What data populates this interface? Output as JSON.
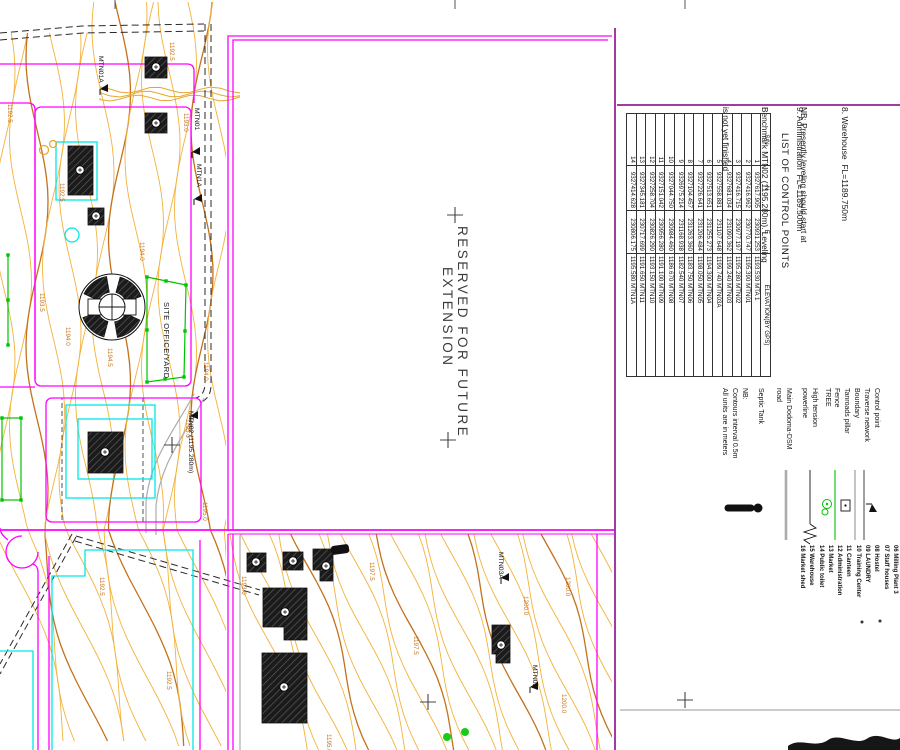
{
  "sheet": {
    "fl_notes": [
      "8. Warehouse  FL=1189.750m",
      "9. Administration  FL=1189.500m"
    ],
    "nb_note_lines": [
      "NB: Presently leveling should start at",
      "Benchmark MTN02 (1195.280m). Leveling",
      "is not yet finished"
    ],
    "table": {
      "title": "LIST OF CONTROL POINTS",
      "columns": [
        "S/N",
        "N",
        "E",
        "ELEVATION(BY GPS)"
      ],
      "rows": [
        [
          "1",
          "9327617.905",
          "230931.253",
          "1193.530 MTA 1"
        ],
        [
          "2",
          "9327416.962",
          "230770.747",
          "1195.390 MTN01"
        ],
        [
          "3",
          "9327416.715",
          "230977.197",
          "1195.280 MTN02"
        ],
        [
          "4",
          "9327681.034",
          "231090.362",
          "1199.240 MTN03"
        ],
        [
          "5",
          "9327558.881",
          "231107.648",
          "1199.740 MTN03A"
        ],
        [
          "6",
          "9327513.651",
          "231255.273",
          "1194.300 MTN04"
        ],
        [
          "7",
          "9327226.641",
          "231206.484",
          "1198.050 MTN05"
        ],
        [
          "8",
          "9327104.457",
          "231263.360",
          "1183.750 MTN06"
        ],
        [
          "9",
          "9326975.214",
          "231168.938",
          "1182.540 MTN07"
        ],
        [
          "10",
          "9327044.750",
          "230984.460",
          "1186.670 MTN08"
        ],
        [
          "11",
          "9327151.042",
          "230956.280",
          "1191.100 MTN09"
        ],
        [
          "12",
          "9327258.704",
          "230826.290",
          "1193.150 MTN10"
        ],
        [
          "13",
          "9327345.181",
          "230717.699",
          "1191.650 MTN11"
        ],
        [
          "14",
          "9327414.628",
          "230806.175",
          "1195.580 MTN1A"
        ]
      ]
    },
    "legend": {
      "items": [
        {
          "symbol": "control-point",
          "lines": [
            "Control point"
          ]
        },
        {
          "symbol": "traverse-network",
          "lines": [
            "Traverse network"
          ]
        },
        {
          "symbol": "boundary",
          "lines": [
            "Boundary"
          ]
        },
        {
          "symbol": "tanroads-pillar",
          "lines": [
            "Tanroads pillar"
          ]
        },
        {
          "symbol": "fence",
          "lines": [
            "Fence"
          ]
        },
        {
          "symbol": "tree",
          "lines": [
            "TREE"
          ]
        },
        {
          "symbol": "high-tension-powerline",
          "lines": [
            "High tension",
            "powerline"
          ]
        },
        {
          "symbol": "main-road",
          "lines": [
            "Main Dodoma-DSM",
            "road"
          ]
        },
        {
          "symbol": "septic-tank",
          "lines": [
            "Septic Tank"
          ]
        }
      ],
      "notes": [
        "NB:",
        "Contours interval 0.5m",
        "All units are in meters"
      ]
    },
    "building_list": [
      "06 Milling Plant 3",
      "07 Staff houses",
      "08 Hostel",
      "09 LAUNDRY",
      "10 Training Center",
      "11 Canteen",
      "12 Administration",
      "13 Market",
      "14 Public toilet",
      "15 Warehouse",
      "16 Market shed"
    ]
  },
  "map": {
    "reserved_label_lines": [
      "RESERVED FOR FUTURE",
      "EXTENSION"
    ],
    "point_labels": [
      "MTN01A",
      "MTN01",
      "MTN1A",
      "MTN02 (1195.280m)",
      "MTN03A",
      "MTN03"
    ],
    "area_labels": [
      "SITE OFFICE/YARD"
    ],
    "contour_labels": [
      "1192.5",
      "1192.5",
      "1193.0",
      "1193.5",
      "1194.0",
      "1194.5",
      "1194.0",
      "1194.0",
      "1195.0",
      "1195.0",
      "1192.5",
      "1192.5",
      "1192.5",
      "1193.0",
      "1195.0",
      "1197.5",
      "1197.5",
      "1200.0",
      "1200.0",
      "1200.0"
    ]
  },
  "colors": {
    "magenta": "#FF00FF",
    "cyan": "#00E8E8",
    "green": "#00C400",
    "contour": "#F3B23C",
    "contour_index": "#C4711B",
    "purple": "#A438A4",
    "gray": "#ACACAC"
  }
}
